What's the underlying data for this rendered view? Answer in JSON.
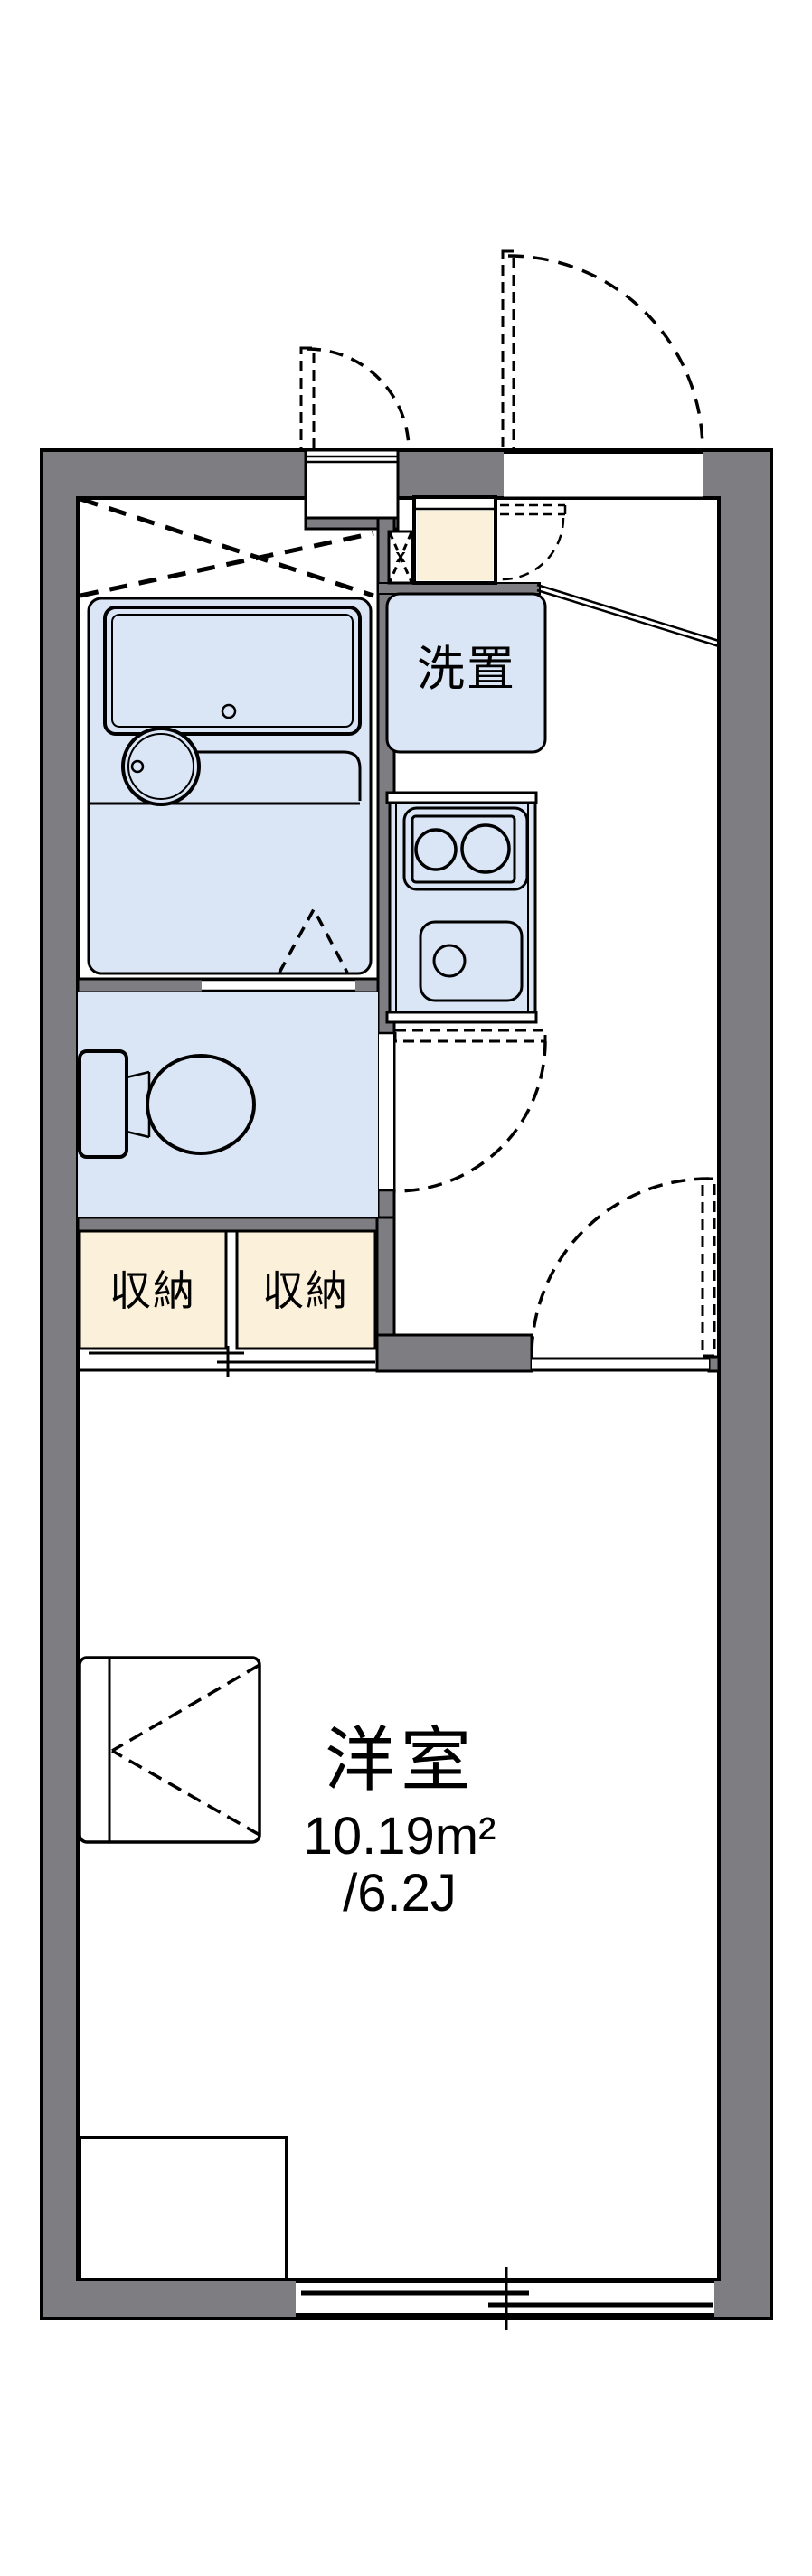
{
  "plan": {
    "rooms": {
      "main_room": {
        "name": "洋室",
        "area_sqm": "10.19m²",
        "area_tatami": "/6.2J"
      },
      "storage_left": {
        "label": "収納"
      },
      "storage_right": {
        "label": "収納"
      },
      "laundry_space": {
        "label": "洗置"
      },
      "pipe_shaft": {
        "mark": "x"
      }
    },
    "colors": {
      "wall_gray": "#7E7E82",
      "fixture_blue": "#DAE6F6",
      "cabinet_cream": "#FBF0D9",
      "outline": "#000000",
      "background": "#FFFFFF"
    }
  }
}
